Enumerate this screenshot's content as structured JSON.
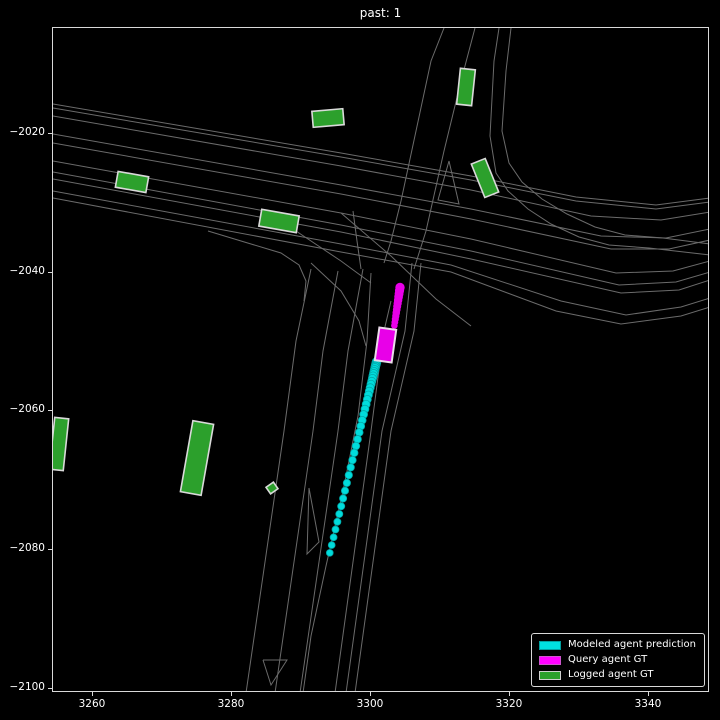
{
  "title": "past: 1",
  "axes": {
    "x_ticks": [
      "3260",
      "3280",
      "3300",
      "3320",
      "3340"
    ],
    "y_ticks": [
      "−2020",
      "−2040",
      "−2060",
      "−2080",
      "−2100"
    ]
  },
  "legend": {
    "items": [
      {
        "label": "Modeled agent prediction",
        "color": "#00e0e0",
        "edge": "#00a0a0"
      },
      {
        "label": "Query agent GT",
        "color": "#ff00ff",
        "edge": "#cc55cc"
      },
      {
        "label": "Logged agent GT",
        "color": "#2ca02c",
        "edge": "#cfcfcf"
      }
    ]
  },
  "colors": {
    "background": "#000000",
    "road_line": "#6b6b6b",
    "spine": "#d9d9d9",
    "green_agent": "#2ca02c",
    "green_edge": "#d9d9d9",
    "magenta": "#e800e8",
    "magenta_edge": "#eadbea",
    "cyan": "#00dcdc",
    "cyan_edge": "#00a8a8"
  },
  "scene": {
    "roads": [
      [
        [
          52,
          103
        ],
        [
          340,
          152
        ],
        [
          470,
          175
        ],
        [
          575,
          196
        ],
        [
          655,
          204
        ],
        [
          709,
          197
        ]
      ],
      [
        [
          52,
          107
        ],
        [
          340,
          156
        ],
        [
          470,
          179
        ],
        [
          575,
          200
        ],
        [
          655,
          208
        ],
        [
          709,
          201
        ]
      ],
      [
        [
          52,
          115
        ],
        [
          340,
          165
        ],
        [
          470,
          189
        ],
        [
          590,
          215
        ],
        [
          660,
          219
        ],
        [
          709,
          211
        ]
      ],
      [
        [
          52,
          133
        ],
        [
          340,
          184
        ],
        [
          470,
          208
        ],
        [
          600,
          235
        ],
        [
          665,
          237
        ],
        [
          709,
          228
        ]
      ],
      [
        [
          52,
          142
        ],
        [
          340,
          193
        ],
        [
          470,
          218
        ],
        [
          610,
          248
        ],
        [
          668,
          248
        ],
        [
          709,
          239
        ]
      ],
      [
        [
          52,
          160
        ],
        [
          340,
          212
        ],
        [
          470,
          238
        ],
        [
          615,
          272
        ],
        [
          672,
          270
        ],
        [
          709,
          260
        ]
      ],
      [
        [
          52,
          171
        ],
        [
          340,
          224
        ],
        [
          470,
          250
        ],
        [
          618,
          284
        ],
        [
          675,
          281
        ],
        [
          709,
          271
        ]
      ],
      [
        [
          52,
          178
        ],
        [
          340,
          231
        ],
        [
          470,
          258
        ],
        [
          620,
          292
        ],
        [
          678,
          289
        ],
        [
          709,
          279
        ]
      ],
      [
        [
          52,
          190
        ],
        [
          340,
          243
        ],
        [
          450,
          264
        ],
        [
          560,
          300
        ],
        [
          625,
          314
        ],
        [
          680,
          306
        ],
        [
          709,
          297
        ]
      ],
      [
        [
          52,
          197
        ],
        [
          340,
          251
        ],
        [
          450,
          271
        ],
        [
          555,
          310
        ],
        [
          620,
          323
        ],
        [
          680,
          315
        ],
        [
          709,
          306
        ]
      ],
      [
        [
          443,
          27
        ],
        [
          430,
          60
        ],
        [
          415,
          130
        ],
        [
          400,
          200
        ],
        [
          390,
          240
        ],
        [
          383,
          262
        ]
      ],
      [
        [
          474,
          27
        ],
        [
          460,
          80
        ],
        [
          443,
          150
        ],
        [
          425,
          230
        ],
        [
          413,
          268
        ]
      ],
      [
        [
          498,
          27
        ],
        [
          493,
          60
        ],
        [
          489,
          135
        ],
        [
          495,
          172
        ],
        [
          507,
          190
        ],
        [
          527,
          208
        ],
        [
          550,
          223
        ],
        [
          578,
          236
        ],
        [
          608,
          244
        ],
        [
          648,
          247
        ],
        [
          709,
          254
        ]
      ],
      [
        [
          510,
          27
        ],
        [
          505,
          70
        ],
        [
          501,
          130
        ],
        [
          508,
          162
        ],
        [
          521,
          181
        ],
        [
          541,
          198
        ],
        [
          566,
          213
        ],
        [
          594,
          226
        ],
        [
          624,
          234
        ],
        [
          662,
          237
        ],
        [
          709,
          243
        ]
      ],
      [
        [
          310,
          268
        ],
        [
          295,
          340
        ],
        [
          283,
          430
        ],
        [
          245,
          692
        ]
      ],
      [
        [
          337,
          270
        ],
        [
          322,
          350
        ],
        [
          312,
          430
        ],
        [
          274,
          692
        ]
      ],
      [
        [
          362,
          268
        ],
        [
          347,
          350
        ],
        [
          337,
          430
        ],
        [
          299,
          692
        ]
      ],
      [
        [
          370,
          272
        ],
        [
          366,
          340
        ],
        [
          357,
          415
        ],
        [
          342,
          490
        ],
        [
          325,
          565
        ],
        [
          310,
          635
        ],
        [
          302,
          692
        ]
      ],
      [
        [
          390,
          300
        ],
        [
          383,
          330
        ],
        [
          370,
          430
        ],
        [
          334,
          692
        ]
      ],
      [
        [
          411,
          262
        ],
        [
          404,
          330
        ],
        [
          381,
          430
        ],
        [
          345,
          692
        ]
      ],
      [
        [
          420,
          262
        ],
        [
          413,
          330
        ],
        [
          390,
          430
        ],
        [
          354,
          692
        ]
      ],
      [
        [
          308,
          487
        ],
        [
          318,
          541
        ],
        [
          306,
          553
        ],
        [
          308,
          487
        ]
      ],
      [
        [
          262,
          659
        ],
        [
          286,
          659
        ],
        [
          270,
          684
        ],
        [
          262,
          659
        ]
      ],
      [
        [
          448,
          160
        ],
        [
          458,
          203
        ],
        [
          437,
          199
        ],
        [
          448,
          160
        ]
      ],
      [
        [
          207,
          230
        ],
        [
          250,
          243
        ],
        [
          280,
          252
        ],
        [
          298,
          264
        ],
        [
          305,
          280
        ],
        [
          303,
          300
        ]
      ],
      [
        [
          310,
          262
        ],
        [
          340,
          290
        ],
        [
          358,
          320
        ],
        [
          365,
          345
        ]
      ],
      [
        [
          340,
          212
        ],
        [
          390,
          255
        ],
        [
          435,
          298
        ],
        [
          470,
          325
        ]
      ],
      [
        [
          352,
          210
        ],
        [
          356,
          240
        ],
        [
          360,
          268
        ]
      ],
      [
        [
          295,
          230
        ],
        [
          340,
          260
        ],
        [
          370,
          282
        ]
      ]
    ],
    "green_agents": [
      {
        "cx": 327,
        "cy": 117,
        "w": 31,
        "h": 16,
        "rot": -5
      },
      {
        "cx": 465,
        "cy": 86,
        "w": 15,
        "h": 36,
        "rot": 6
      },
      {
        "cx": 484,
        "cy": 177,
        "w": 15,
        "h": 36,
        "rot": -22
      },
      {
        "cx": 131,
        "cy": 181,
        "w": 31,
        "h": 16,
        "rot": 10
      },
      {
        "cx": 278,
        "cy": 220,
        "w": 38,
        "h": 17,
        "rot": 10
      },
      {
        "cx": 196,
        "cy": 457,
        "w": 21,
        "h": 72,
        "rot": 10
      },
      {
        "cx": 58,
        "cy": 443,
        "w": 14,
        "h": 52,
        "rot": 6
      },
      {
        "cx": 271,
        "cy": 487,
        "w": 9,
        "h": 8,
        "rot": -35
      }
    ],
    "query_agent": {
      "cx": 384.5,
      "cy": 344,
      "w": 17,
      "h": 33,
      "rot": 8
    },
    "magenta_trail": {
      "start": [
        399,
        286.5
      ],
      "end": [
        393,
        327
      ],
      "r0": 4.3,
      "r1": 2.9,
      "gaps": [
        0,
        3.2,
        3.2,
        3.2,
        3.2,
        3.2,
        3.2,
        3.2,
        3.2,
        3.2,
        3.2,
        3.2,
        3.2
      ]
    },
    "cyan_trail": {
      "start": [
        375.5,
        361
      ],
      "end": [
        329,
        551
      ],
      "r0": 4.4,
      "r1": 3.4,
      "gaps": [
        0,
        1.5,
        1.5,
        1.5,
        1.5,
        2,
        2,
        2,
        2.5,
        2.5,
        3,
        3,
        3.5,
        3.5,
        4,
        4.5,
        5,
        5,
        5.5,
        6,
        6,
        6.5,
        7,
        7,
        7,
        7.5,
        7.5,
        8,
        8,
        8,
        8,
        8,
        8,
        8,
        8,
        8,
        8,
        8
      ]
    }
  },
  "chart_data": {
    "type": "scatter",
    "title": "past: 1",
    "xlabel": "",
    "ylabel": "",
    "xlim": [
      3254.2,
      3348.9
    ],
    "ylim": [
      -2100.5,
      -2004.6
    ],
    "x_ticks": [
      3260,
      3280,
      3300,
      3320,
      3340
    ],
    "y_ticks": [
      -2020,
      -2040,
      -2060,
      -2080,
      -2100
    ],
    "grid": false,
    "background": "black",
    "legend_position": "lower right",
    "series": [
      {
        "name": "Modeled agent prediction",
        "type": "trajectory_dots",
        "color": "cyan",
        "from_xy": [
          3300.8,
          -2052.8
        ],
        "to_xy": [
          3294.2,
          -2080.2
        ],
        "n_points": 38
      },
      {
        "name": "Query agent GT",
        "type": "box_with_trail",
        "color": "magenta",
        "box_center": [
          3302.1,
          -2050.3
        ],
        "box_size": [
          2.4,
          4.8
        ],
        "trail_from": [
          3304.2,
          -2042.1
        ],
        "trail_to": [
          3303.4,
          -2047.9
        ]
      },
      {
        "name": "Logged agent GT",
        "type": "boxes",
        "color": "green",
        "box_centers": [
          [
            3293.9,
            -2017.6
          ],
          [
            3313.9,
            -2013.2
          ],
          [
            3316.5,
            -2026.1
          ],
          [
            3265.6,
            -2026.8
          ],
          [
            3286.8,
            -2032.5
          ],
          [
            3275.0,
            -2066.6
          ],
          [
            3255.1,
            -2064.5
          ],
          [
            3285.8,
            -2071.0
          ]
        ]
      }
    ],
    "map": "road lane polylines drawn as thin gray lines over black background"
  }
}
